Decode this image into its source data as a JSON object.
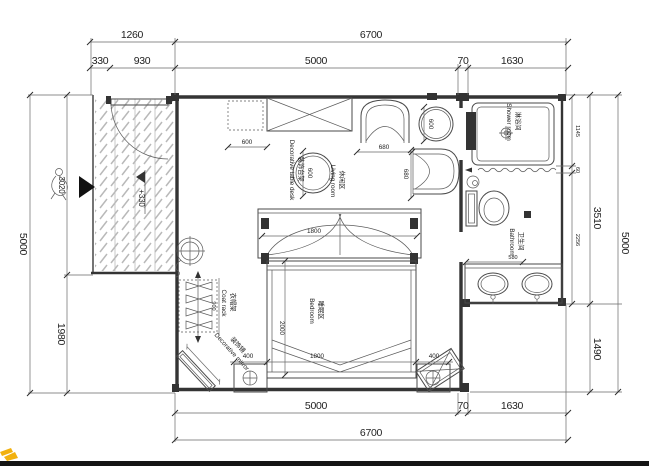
{
  "drawing": {
    "level_marker": "+330",
    "dims": {
      "top_outer": [
        "1260",
        "6700"
      ],
      "top_inner": [
        "330",
        "930",
        "5000",
        "70",
        "1630"
      ],
      "bottom_inner": [
        "5000",
        "70",
        "1630"
      ],
      "bottom_outer": [
        "6700"
      ],
      "left_outer": [
        "5000"
      ],
      "left_inner": [
        "3020",
        "1980"
      ],
      "right_inner": [
        "1145",
        "60",
        "2256"
      ],
      "right_mid": [
        "3510",
        "1490"
      ],
      "right_outer": [
        "5000"
      ]
    },
    "interior": {
      "cabinet": "600",
      "deco_table": "600",
      "side_table": "600",
      "chair_w": "680",
      "chair_d": "680",
      "canopy": "1800",
      "bed_len": "2000",
      "bed_w": "1800",
      "ns_left": "400",
      "ns_right": "400",
      "coat_rack": "900",
      "vanity": "580"
    },
    "labels": {
      "shower": {
        "zh": "淋浴间",
        "en": "Shower room"
      },
      "bathroom": {
        "zh": "卫生间",
        "en": "Bathroom"
      },
      "living": {
        "zh": "休闲区",
        "en": "Living room"
      },
      "bedroom": {
        "zh": "睡眠区",
        "en": "Bedroom"
      },
      "coat_rack": {
        "zh": "衣帽架",
        "en": "Coat rack"
      },
      "mirror": {
        "zh": "装饰镜",
        "en": "Decorative mirror"
      },
      "deco_table": {
        "zh": "装饰台架",
        "en": "Decorative table desk"
      }
    },
    "colors": {
      "line": "#3c3c3c",
      "hatch": "#b9b9b9",
      "watermark": "#f2b10e",
      "footer_bar": "#141414"
    }
  }
}
